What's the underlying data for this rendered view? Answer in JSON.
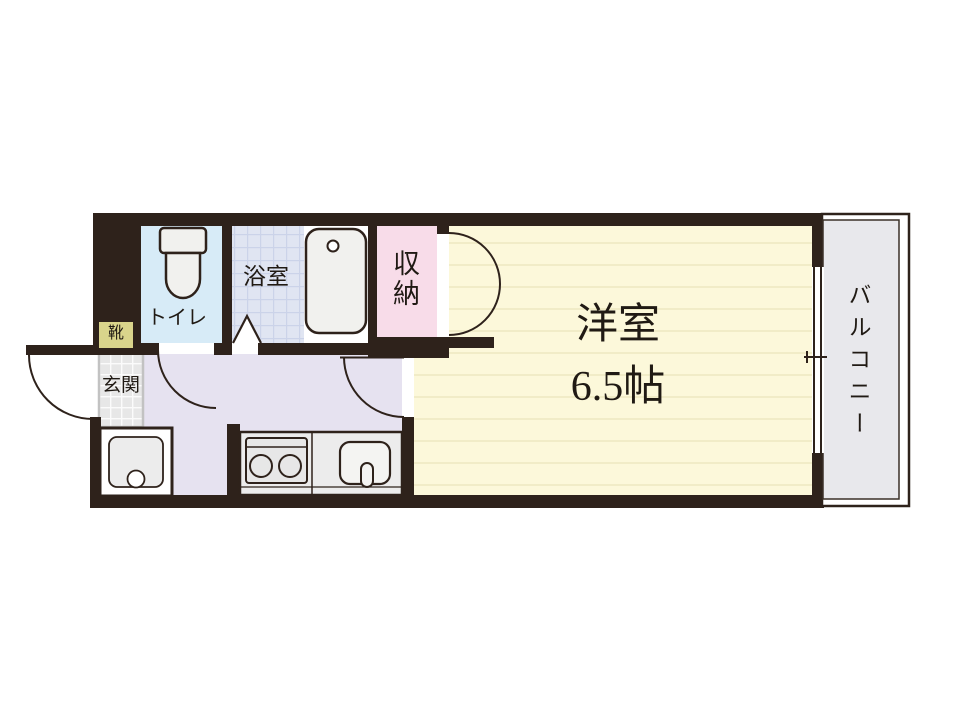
{
  "floor_plan": {
    "kind": "apartment-floor-plan",
    "rooms": {
      "western_room": {
        "name": "洋室",
        "size": "6.5帖"
      },
      "balcony": {
        "label": "バルコニー"
      },
      "bathroom": {
        "label": "浴室"
      },
      "toilet": {
        "label": "トイレ"
      },
      "storage": {
        "label": "収納"
      },
      "entrance": {
        "label": "玄関"
      },
      "shoe_cabinet": {
        "label": "靴"
      }
    },
    "fixtures": [
      "toilet-icon",
      "bathtub-icon",
      "washing-machine-icon",
      "stove-icon",
      "kitchen-sink-icon"
    ],
    "features": [
      "entrance-door-swing",
      "toilet-door-swing",
      "bathroom-folding-door",
      "room-door-swing",
      "closet-double-doors",
      "balcony-window"
    ],
    "colors": {
      "wall": "#2e221b",
      "western_room": "#fcf8da",
      "western_room_stripe": "#f1ecc7",
      "toilet": "#d7ebf7",
      "bathroom": "#e0e5f2",
      "bathroom_grid": "#cbd3e9",
      "storage": "#f8dce9",
      "hall": "#e6e2f0",
      "entrance": "#e7e7e7",
      "shoe_cabinet": "#d9d48b",
      "balcony": "#e8e8ec",
      "fixture_fill": "#f1f1ee"
    }
  }
}
